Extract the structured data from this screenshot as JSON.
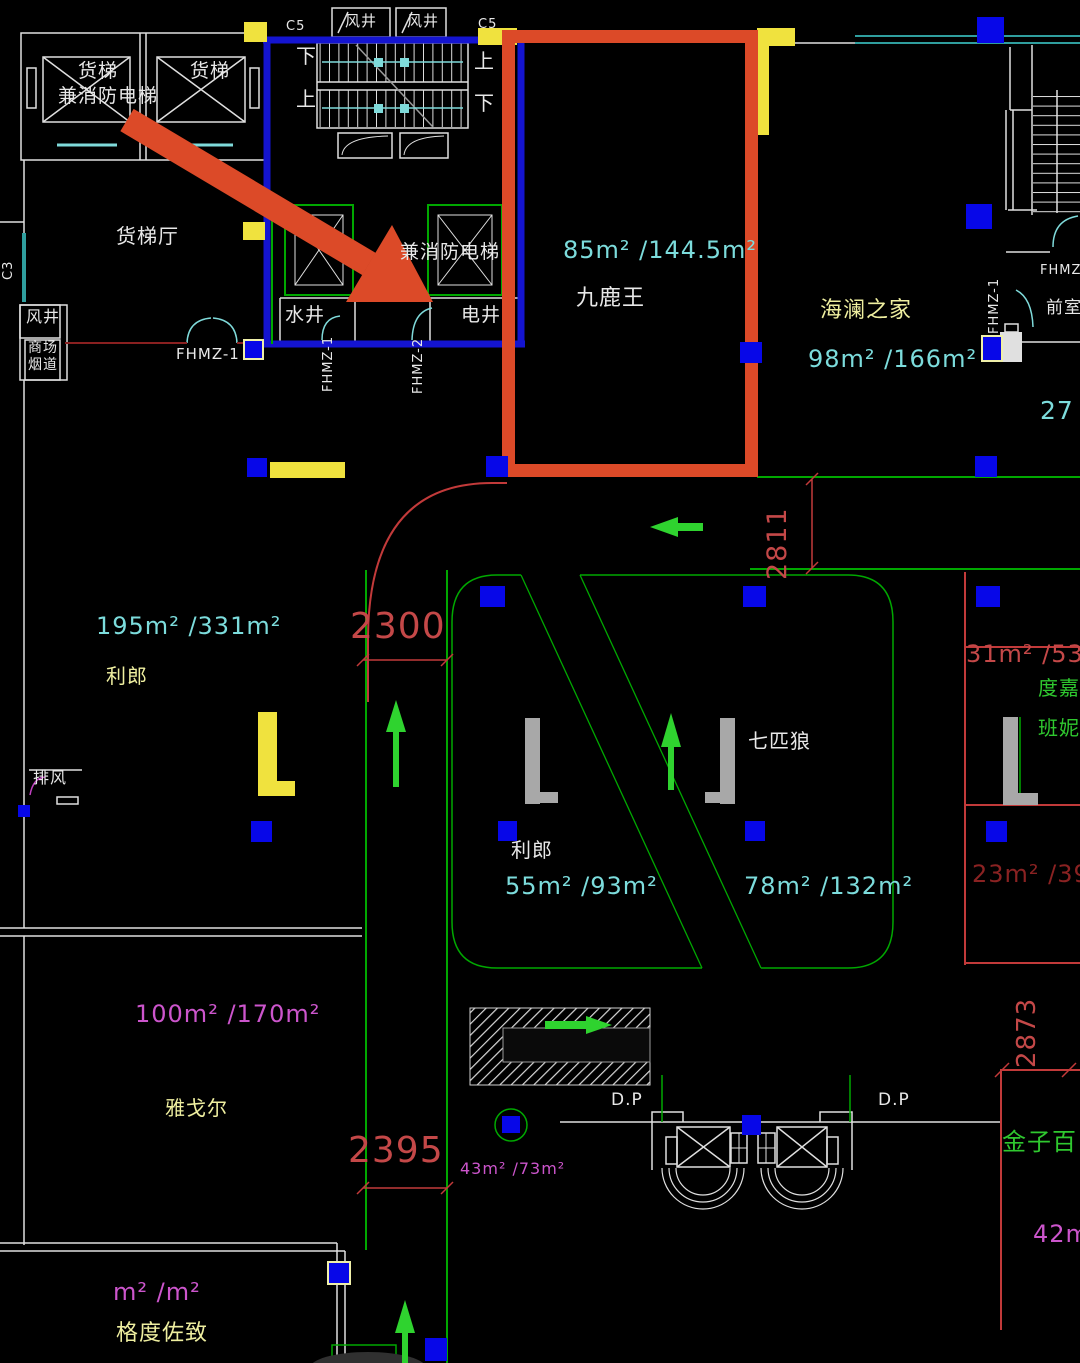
{
  "canvas": {
    "width": 1080,
    "height": 1363,
    "background": "#000000"
  },
  "colors": {
    "white": "#E8E8E8",
    "paleyellow": "#EFEFA0",
    "cyan": "#7CDCDC",
    "red": "#C44848",
    "darkred": "#8A2222",
    "magenta": "#CC55CC",
    "green": "#2FC82F",
    "highlight": "#DC4A28",
    "wall_blue": "#1414D0",
    "wall_green": "#00A800",
    "wall_teal": "#2F9E9E",
    "square_blue": "#0707E8",
    "accent_yellow": "#F0E23E"
  },
  "annotation": {
    "highlight_box_shop": "九鹿王",
    "arrow_color": "#DC4A28"
  },
  "labels": [
    {
      "name": "cargo-lift-1-label",
      "text": "货梯",
      "x": 78,
      "y": 62,
      "size": 19,
      "color": "white"
    },
    {
      "name": "cargo-fire-lift-label",
      "text": "兼消防电梯",
      "x": 58,
      "y": 87,
      "size": 19,
      "color": "white"
    },
    {
      "name": "cargo-lift-2-label",
      "text": "货梯",
      "x": 190,
      "y": 62,
      "size": 19,
      "color": "white"
    },
    {
      "name": "grid-c5-left",
      "text": "C5",
      "x": 286,
      "y": 20,
      "size": 13,
      "color": "white"
    },
    {
      "name": "wind-shaft-top-1",
      "text": "风井",
      "x": 345,
      "y": 14,
      "size": 15,
      "color": "white"
    },
    {
      "name": "wind-shaft-top-2",
      "text": "风井",
      "x": 407,
      "y": 14,
      "size": 15,
      "color": "white"
    },
    {
      "name": "grid-c5-right",
      "text": "C5",
      "x": 478,
      "y": 18,
      "size": 13,
      "color": "white"
    },
    {
      "name": "stair-down-left",
      "text": "下",
      "x": 296,
      "y": 46,
      "size": 20,
      "color": "white"
    },
    {
      "name": "stair-up-left",
      "text": "上",
      "x": 296,
      "y": 89,
      "size": 20,
      "color": "white"
    },
    {
      "name": "stair-up-right",
      "text": "上",
      "x": 474,
      "y": 51,
      "size": 20,
      "color": "white"
    },
    {
      "name": "stair-down-right",
      "text": "下",
      "x": 474,
      "y": 93,
      "size": 20,
      "color": "white"
    },
    {
      "name": "cargo-hall-label",
      "text": "货梯厅",
      "x": 116,
      "y": 226,
      "size": 20,
      "color": "white"
    },
    {
      "name": "grid-c3",
      "text": "C3",
      "x": 2,
      "y": 280,
      "size": 13,
      "color": "white",
      "rotate": -90
    },
    {
      "name": "wind-shaft-left",
      "text": "风井",
      "x": 26,
      "y": 309,
      "size": 16,
      "color": "white"
    },
    {
      "name": "mall-flue-line1",
      "text": "商场",
      "x": 28,
      "y": 341,
      "size": 14,
      "color": "white"
    },
    {
      "name": "mall-flue-line2",
      "text": "烟道",
      "x": 28,
      "y": 358,
      "size": 14,
      "color": "white"
    },
    {
      "name": "fhmz1-hall-tag",
      "text": "FHMZ-1",
      "x": 176,
      "y": 347,
      "size": 15,
      "color": "white"
    },
    {
      "name": "fire-lift-label",
      "text": "兼消防电梯",
      "x": 400,
      "y": 243,
      "size": 19,
      "color": "white"
    },
    {
      "name": "water-shaft-label",
      "text": "水井",
      "x": 285,
      "y": 306,
      "size": 19,
      "color": "white"
    },
    {
      "name": "elec-shaft-label",
      "text": "电井",
      "x": 461,
      "y": 306,
      "size": 19,
      "color": "white"
    },
    {
      "name": "fhmz1-core-tag",
      "text": "FHMZ-1",
      "x": 322,
      "y": 392,
      "size": 13,
      "color": "white",
      "rotate": -90
    },
    {
      "name": "fhmz2-core-tag",
      "text": "FHMZ-2",
      "x": 412,
      "y": 394,
      "size": 13,
      "color": "white",
      "rotate": -90
    },
    {
      "name": "area-85",
      "text": "85m² /144.5m²",
      "x": 563,
      "y": 238,
      "size": 24,
      "color": "cyan"
    },
    {
      "name": "shop-jiuluwang",
      "text": "九鹿王",
      "x": 576,
      "y": 287,
      "size": 22,
      "color": "white"
    },
    {
      "name": "shop-hailan",
      "text": "海澜之家",
      "x": 820,
      "y": 299,
      "size": 22,
      "color": "paleyellow"
    },
    {
      "name": "area-98",
      "text": "98m² /166m²",
      "x": 808,
      "y": 347,
      "size": 24,
      "color": "cyan"
    },
    {
      "name": "fhmz1-right-tag",
      "text": "FHMZ-1",
      "x": 988,
      "y": 334,
      "size": 13,
      "color": "white",
      "rotate": -90
    },
    {
      "name": "fhmz-right-partial",
      "text": "FHMZ-",
      "x": 1040,
      "y": 264,
      "size": 13,
      "color": "white"
    },
    {
      "name": "front-room-label",
      "text": "前室",
      "x": 1046,
      "y": 300,
      "size": 17,
      "color": "white"
    },
    {
      "name": "area-27",
      "text": "27",
      "x": 1040,
      "y": 398,
      "size": 25,
      "color": "cyan"
    },
    {
      "name": "dim-2811",
      "text": "2811",
      "x": 764,
      "y": 580,
      "size": 27,
      "color": "red",
      "rotate": -90
    },
    {
      "name": "area-195",
      "text": "195m² /331m²",
      "x": 96,
      "y": 614,
      "size": 24,
      "color": "cyan"
    },
    {
      "name": "shop-lilang-left",
      "text": "利郎",
      "x": 106,
      "y": 666,
      "size": 20,
      "color": "paleyellow"
    },
    {
      "name": "dim-2300",
      "text": "2300",
      "x": 350,
      "y": 608,
      "size": 36,
      "color": "red"
    },
    {
      "name": "shop-qipilang",
      "text": "七匹狼",
      "x": 748,
      "y": 731,
      "size": 20,
      "color": "white"
    },
    {
      "name": "shop-lilang-mid",
      "text": "利郎",
      "x": 511,
      "y": 840,
      "size": 20,
      "color": "white"
    },
    {
      "name": "area-55",
      "text": "55m² /93m²",
      "x": 505,
      "y": 874,
      "size": 24,
      "color": "cyan"
    },
    {
      "name": "area-78",
      "text": "78m² /132m²",
      "x": 744,
      "y": 874,
      "size": 24,
      "color": "cyan"
    },
    {
      "name": "area-31",
      "text": "31m² /53m²",
      "x": 966,
      "y": 642,
      "size": 24,
      "color": "red"
    },
    {
      "name": "shop-dujia",
      "text": "度嘉",
      "x": 1038,
      "y": 678,
      "size": 20,
      "color": "green"
    },
    {
      "name": "shop-banni",
      "text": "班妮",
      "x": 1038,
      "y": 718,
      "size": 20,
      "color": "green"
    },
    {
      "name": "area-23",
      "text": "23m² /39m²",
      "x": 972,
      "y": 862,
      "size": 24,
      "color": "darkred"
    },
    {
      "name": "exhaust-label",
      "text": "排风",
      "x": 33,
      "y": 770,
      "size": 16,
      "color": "white"
    },
    {
      "name": "area-100",
      "text": "100m² /170m²",
      "x": 135,
      "y": 1002,
      "size": 24,
      "color": "magenta"
    },
    {
      "name": "shop-yagor",
      "text": "雅戈尔",
      "x": 165,
      "y": 1098,
      "size": 20,
      "color": "paleyellow"
    },
    {
      "name": "dim-2395",
      "text": "2395",
      "x": 348,
      "y": 1132,
      "size": 36,
      "color": "red"
    },
    {
      "name": "area-43",
      "text": "43m² /73m²",
      "x": 460,
      "y": 1161,
      "size": 16,
      "color": "magenta"
    },
    {
      "name": "dp-left",
      "text": "D.P",
      "x": 611,
      "y": 1092,
      "size": 17,
      "color": "white"
    },
    {
      "name": "dp-right",
      "text": "D.P",
      "x": 878,
      "y": 1092,
      "size": 17,
      "color": "white"
    },
    {
      "name": "dim-2873",
      "text": "2873",
      "x": 1014,
      "y": 1068,
      "size": 26,
      "color": "red",
      "rotate": -90
    },
    {
      "name": "shop-jinzibai",
      "text": "金子百",
      "x": 1002,
      "y": 1130,
      "size": 24,
      "color": "green"
    },
    {
      "name": "area-42",
      "text": "42m²",
      "x": 1033,
      "y": 1222,
      "size": 24,
      "color": "magenta"
    },
    {
      "name": "area-blank",
      "text": "m² /m²",
      "x": 113,
      "y": 1280,
      "size": 24,
      "color": "magenta"
    },
    {
      "name": "shop-geduzuozhi",
      "text": "格度佐致",
      "x": 116,
      "y": 1322,
      "size": 22,
      "color": "paleyellow"
    }
  ]
}
